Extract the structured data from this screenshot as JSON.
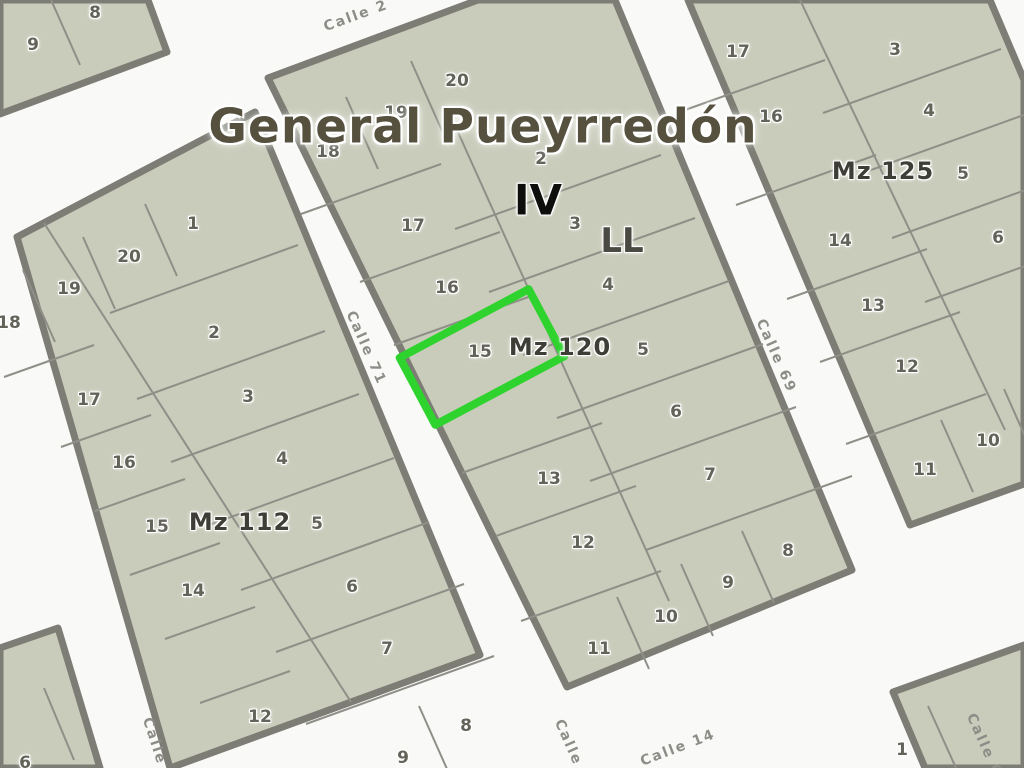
{
  "title": "General Pueyrredón",
  "district_roman": "IV",
  "zone_label": "LL",
  "highlight_color": "#2ed32e",
  "block_labels": {
    "mz112": "Mz 112",
    "mz120": "Mz 120",
    "mz125": "Mz 125"
  },
  "highlighted_lot": "15",
  "streets": {
    "top": "Calle 2",
    "left_mid": "Calle 71",
    "right_mid": "Calle 69",
    "bottom_left": "Calle 7",
    "bottom_center": "Calle 7",
    "calle14": "Calle 14",
    "bottom_right": "Calle 6"
  },
  "lots": {
    "nw": [
      "9",
      "8"
    ],
    "mz112": [
      "1",
      "20",
      "19",
      "18",
      "2",
      "17",
      "3",
      "16",
      "4",
      "15",
      "5",
      "14",
      "6",
      "12",
      "7",
      "8",
      "9"
    ],
    "mz120": [
      "20",
      "19",
      "18",
      "2",
      "17",
      "3",
      "16",
      "4",
      "15",
      "5",
      "6",
      "13",
      "7",
      "12",
      "8",
      "9",
      "10",
      "11"
    ],
    "mz125": [
      "17",
      "3",
      "16",
      "4",
      "5",
      "14",
      "6",
      "13",
      "12",
      "10",
      "11"
    ],
    "sw": [
      "6"
    ],
    "se": [
      "1"
    ]
  }
}
